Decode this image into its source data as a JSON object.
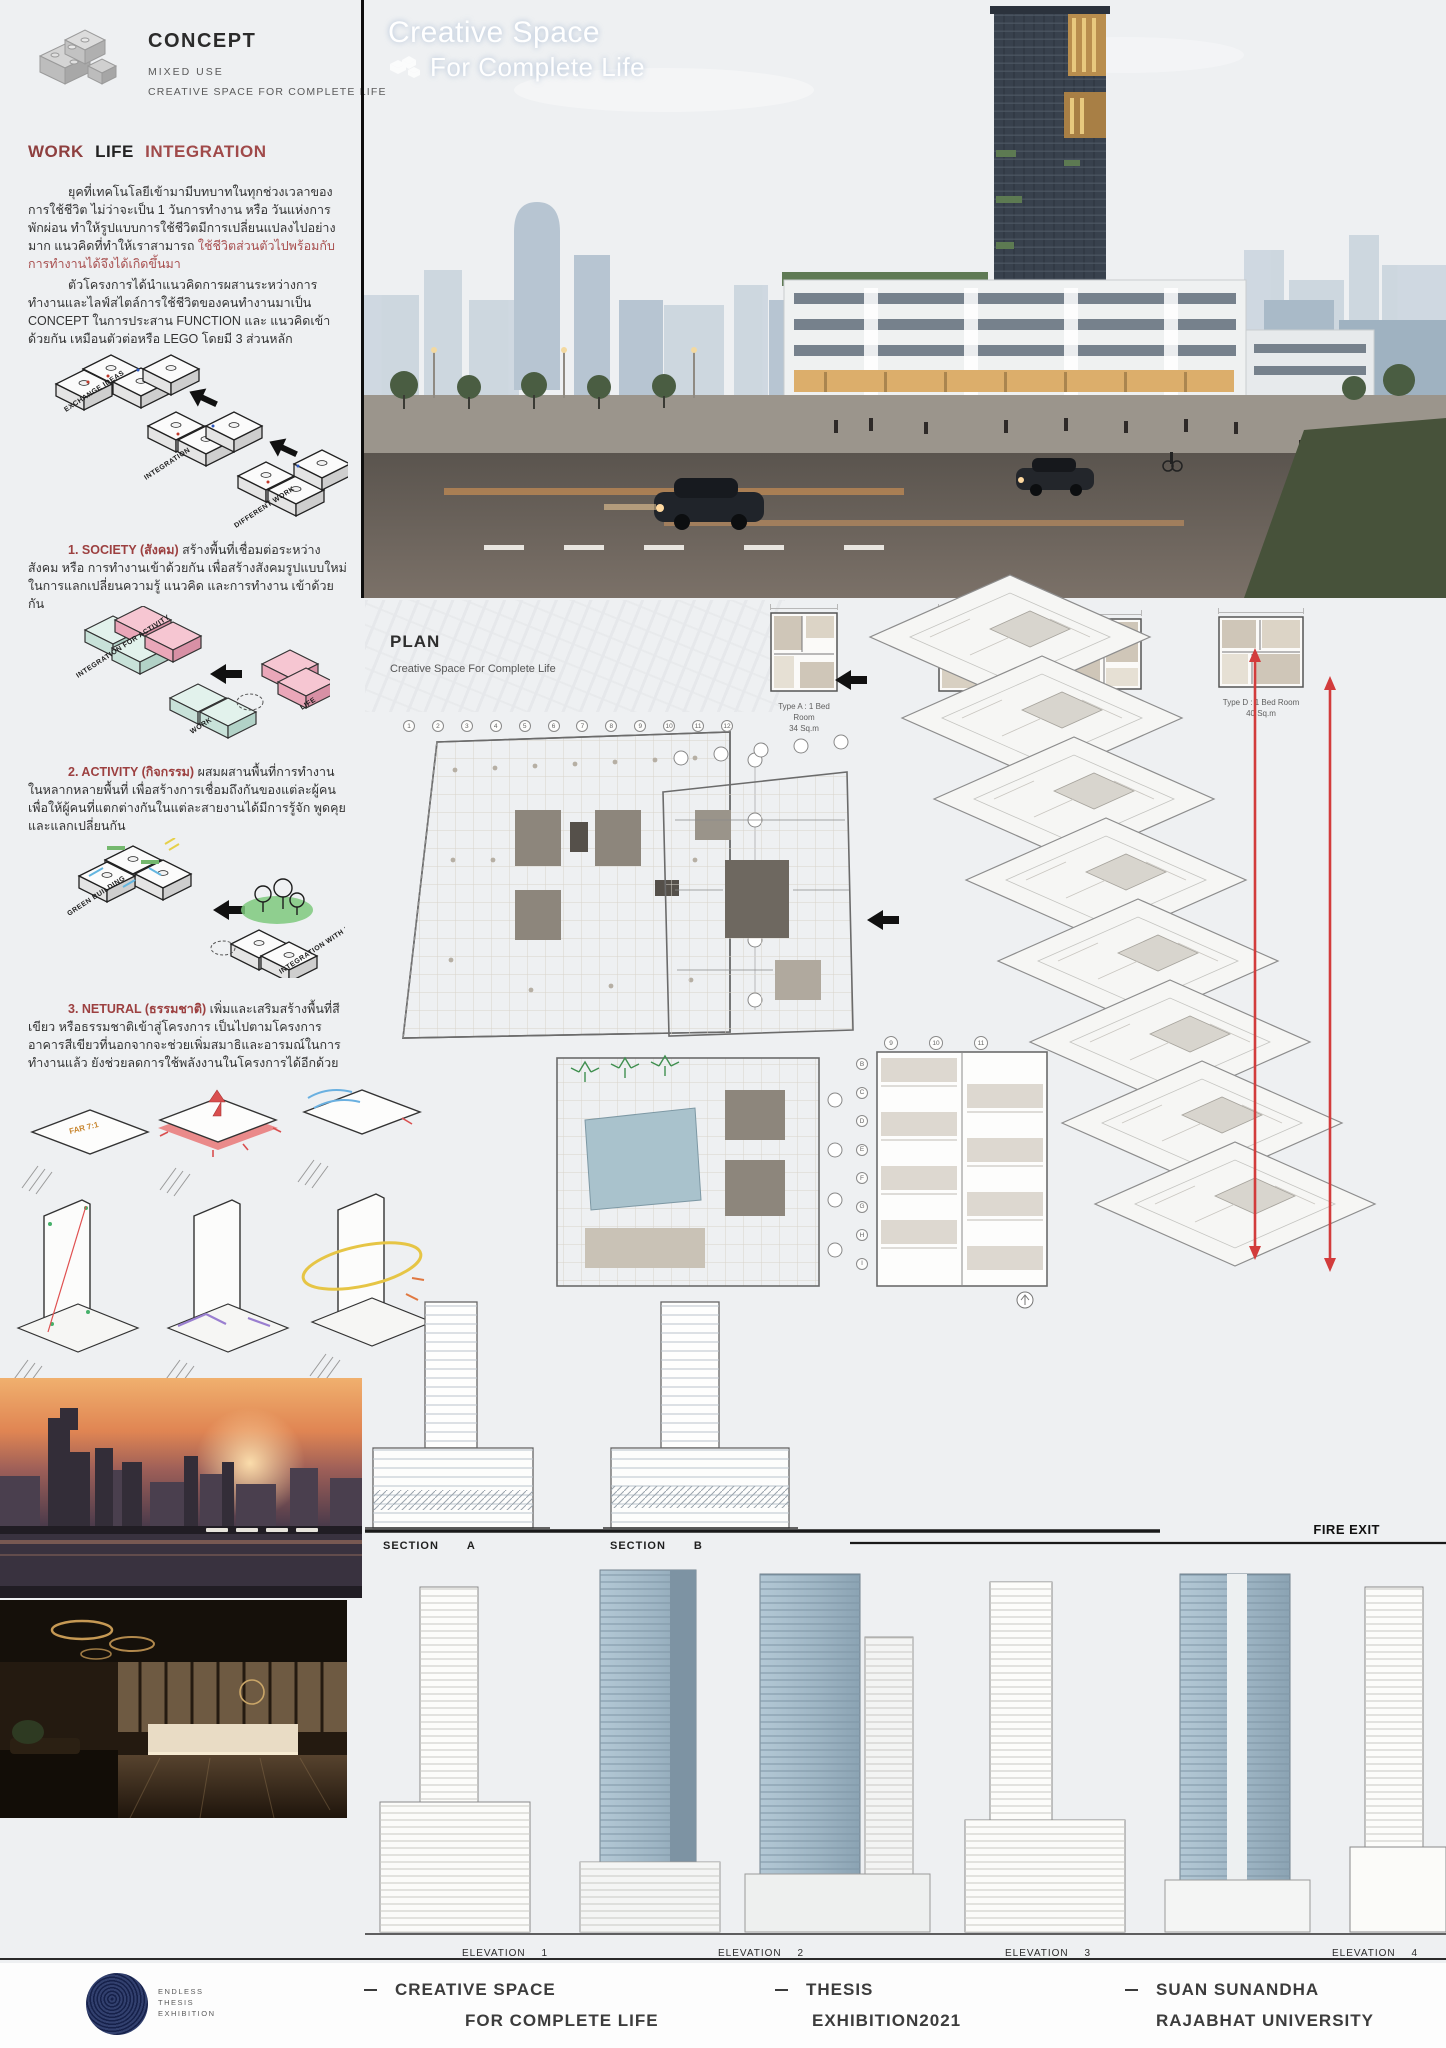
{
  "concept": {
    "title": "CONCEPT",
    "line1": "MIXED USE",
    "line2": "CREATIVE SPACE FOR COMPLETE LIFE"
  },
  "heading": {
    "work": "WORK",
    "life": "LIFE",
    "integration": "INTEGRATION"
  },
  "intro": {
    "p1": "ยุคที่เทคโนโลยีเข้ามามีบทบาทในทุกช่วงเวลาของการใช้ชีวิต ไม่ว่าจะเป็น 1 วันการทำงาน หรือ วันแห่งการพักผ่อน ทำให้รูปแบบการใช้ชีวิตมีการเปลี่ยนแปลงไปอย่างมาก แนวคิดที่ทำให้เราสามารถ ",
    "p1_red": "ใช้ชีวิตส่วนตัวไปพร้อมกับการทำงานได้จึงได้เกิดขึ้นมา",
    "p2": "ตัวโครงการได้นำแนวคิดการผสานระหว่างการทำงานและไลฟ์สไตล์การใช้ชีวิตของคนทำงานมาเป็น CONCEPT ในการประสาน FUNCTION และ แนวคิดเข้าด้วยกัน เหมือนตัวต่อหรือ LEGO โดยมี 3 ส่วนหลัก"
  },
  "diagram1": {
    "l1": "EXCHANGE IDEAS",
    "l2": "INTEGRATION",
    "l3": "DIFFERENT WORK"
  },
  "society": {
    "lead": "1. SOCIETY (สังคม)",
    "text": " สร้างพื้นที่เชื่อมต่อระหว่างสังคม หรือ การทำงานเข้าด้วยกัน เพื่อสร้างสังคมรูปแบบใหม่ในการแลกเปลี่ยนความรู้ แนวคิด และการทำงาน เข้าด้วยกัน"
  },
  "diagram2": {
    "l1": "INTEGRATION FOR ACTIVITY",
    "l2": "WORK",
    "l3": "LIFE"
  },
  "activity": {
    "lead": "2. ACTIVITY (กิจกรรม)",
    "text": " ผสมผสานพื้นที่การทำงานในหลากหลายพื้นที่ เพื่อสร้างการเชื่อมถึงกันของแต่ละผู้คน เพื่อให้ผู้คนที่แตกต่างกันในแต่ละสายงานได้มีการรู้จัก พูดคุย และแลกเปลี่ยนกัน"
  },
  "diagram3": {
    "l1": "GREEN BUILDING",
    "l2": "INTEGRATION WITH NATURAL"
  },
  "natural": {
    "lead": "3. NETURAL (ธรรมชาติ)",
    "text": " เพิ่มและเสริมสร้างพื้นที่สีเขียว หรือธรรมชาติเข้าสู่โครงการ เป็นไปตามโครงการอาคารสีเขียวที่นอกจากจะช่วยเพิ่มสมาธิและอารมณ์ในการทำงานแล้ว ยังช่วยลดการใช้พลังงานในโครงการได้อีกด้วย"
  },
  "massing": {
    "far": "FAR 7:1"
  },
  "hero": {
    "title1": "Creative Space",
    "title2": "For Complete Life"
  },
  "plan": {
    "title": "PLAN",
    "subtitle": "Creative Space For Complete Life",
    "units": [
      {
        "type": "Type A : 1 Bed Room",
        "area": "34 Sq.m"
      },
      {
        "type": "Type B : 1 Bed Room",
        "area": "32 Sq.m"
      },
      {
        "type": "Type C : 1 Bed Room",
        "area": ""
      },
      {
        "type": "Type D : 1 Bed Room",
        "area": "40 Sq.m"
      }
    ],
    "grid_numbers": [
      "1",
      "2",
      "3",
      "4",
      "5",
      "6",
      "7",
      "8",
      "9",
      "10",
      "11",
      "12"
    ],
    "grid_numbers_b": [
      "9",
      "10",
      "11"
    ],
    "grid_letters": [
      "B",
      "C",
      "D",
      "E",
      "F",
      "G",
      "H",
      "I"
    ]
  },
  "sections": [
    {
      "label": "SECTION",
      "num": "A"
    },
    {
      "label": "SECTION",
      "num": "B"
    }
  ],
  "fire_exit": "FIRE EXIT",
  "elevations": [
    {
      "label": "ELEVATION",
      "num": "1"
    },
    {
      "label": "ELEVATION",
      "num": "2"
    },
    {
      "label": "ELEVATION",
      "num": "3"
    },
    {
      "label": "ELEVATION",
      "num": "4"
    }
  ],
  "footer": {
    "logo_lines": [
      "ENDLESS",
      "THESIS",
      "EXHIBITION"
    ],
    "items": [
      {
        "l1": "CREATIVE SPACE",
        "l2": "FOR COMPLETE LIFE"
      },
      {
        "l1": "THESIS",
        "l2": "EXHIBITION2021"
      },
      {
        "l1": "SUAN SUNANDHA",
        "l2": "RAJABHAT UNIVERSITY"
      }
    ]
  },
  "colors": {
    "accent_red": "#9c4343",
    "navy": "#1e2a55",
    "pink": "#f0b6c4",
    "mint": "#cfe7dd",
    "green": "#6fbe6f",
    "sky": "#85b2dd"
  }
}
